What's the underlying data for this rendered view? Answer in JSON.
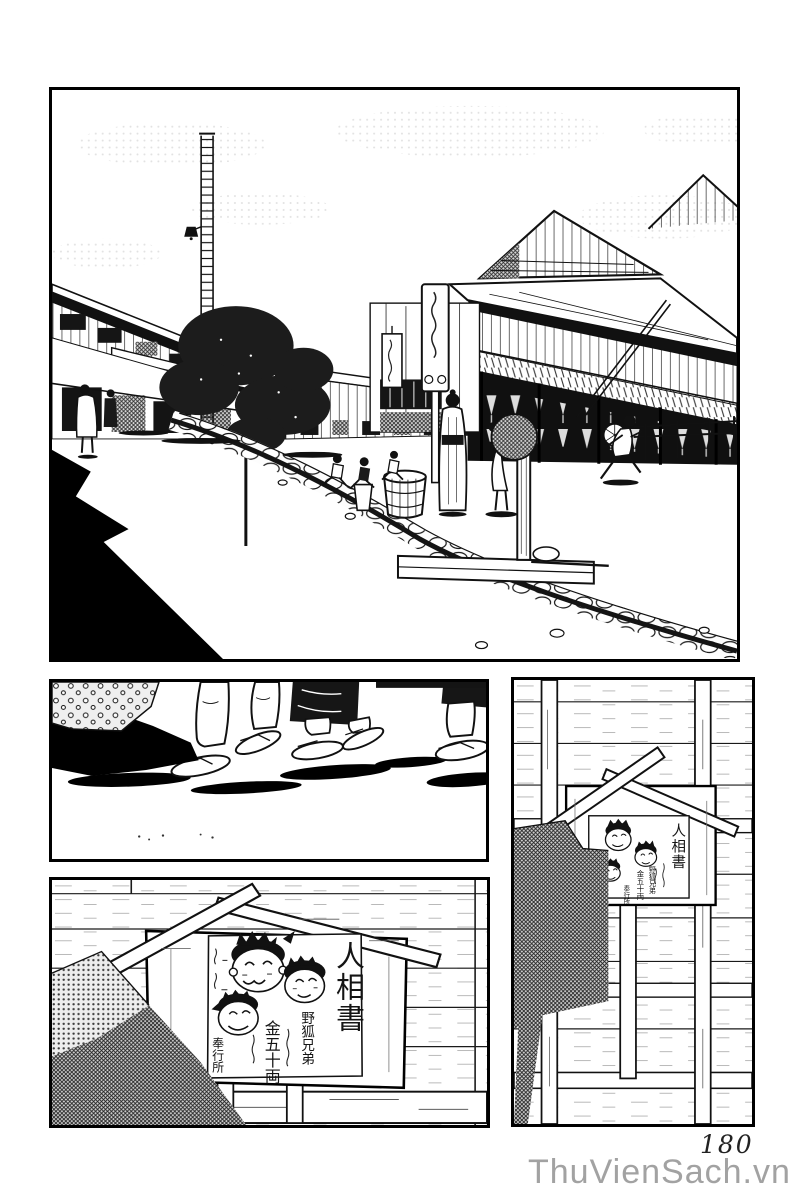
{
  "page": {
    "number": "180",
    "watermark": "ThuVienSach.vn"
  },
  "wanted_poster": {
    "title": "人相書",
    "suspects": "野狐兄弟",
    "reward": "金五十両",
    "issuer": "奉行所"
  }
}
